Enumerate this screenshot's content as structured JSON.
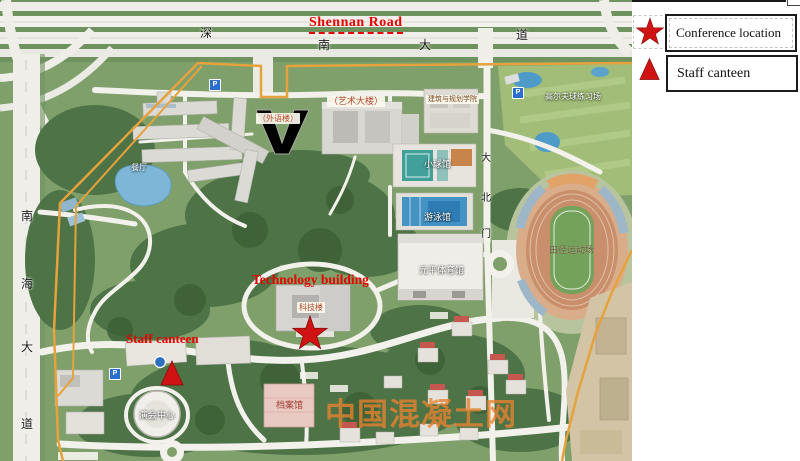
{
  "legend": {
    "items": [
      {
        "symbol": "star-icon",
        "label": "Conference location"
      },
      {
        "symbol": "triangle-icon",
        "label": "Staff canteen"
      }
    ]
  },
  "annotations": {
    "shennan_road": "Shennan Road",
    "technology_building": "Technology building",
    "staff_canteen": "Staff canteen"
  },
  "watermark": {
    "text": "中国混凝土网"
  },
  "map": {
    "parking_label": "P",
    "shennan_road_chars": [
      "深",
      "南",
      "大",
      "道"
    ],
    "nanhai_road_chars": [
      "南",
      "海",
      "大",
      "道"
    ],
    "north_gate_chars": [
      "大",
      "北",
      "门"
    ],
    "building_labels": {
      "art_building": "（艺术大楼）",
      "foreign_language_building": "（外语楼）",
      "architecture_college": "建筑与规划学院",
      "small_ball_hall": "小球馆",
      "swimming_hall": "游泳馆",
      "yuanping_gym": "元平体育馆",
      "athletics_field": "田径运动场",
      "golf_range": "高尔夫球练习场",
      "performance_center": "演会中心",
      "archives_hall": "档案馆",
      "technology_building": "科技楼",
      "canteen": "餐厅"
    }
  },
  "colors": {
    "annotation_red": "#e80000",
    "marker_red": "#cf1313",
    "boundary_orange": "#e6a23c",
    "watermark_orange": "#e8832f"
  }
}
